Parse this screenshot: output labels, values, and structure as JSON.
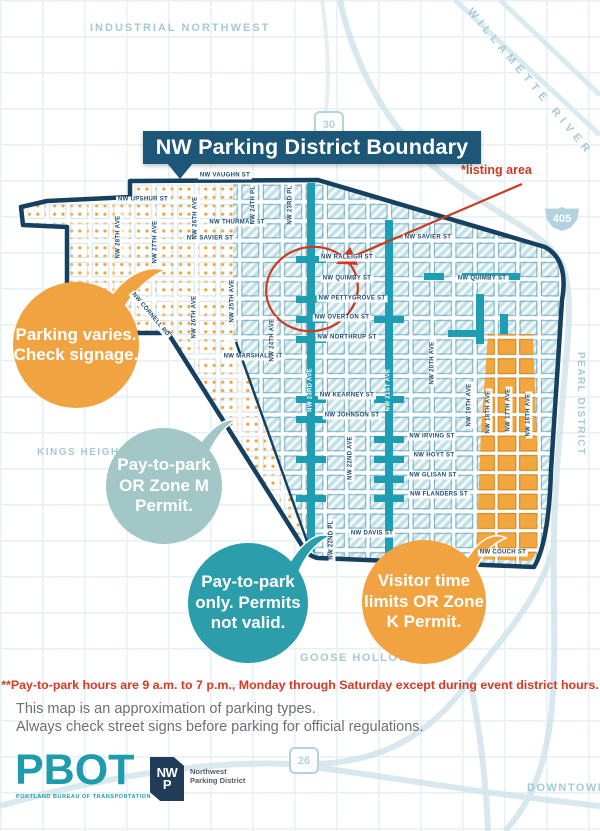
{
  "banner": {
    "title": "NW Parking District Boundary"
  },
  "annotation": {
    "listing_area": "*listing area",
    "color": "#cc3a22"
  },
  "map": {
    "region_labels": [
      {
        "t": "INDUSTRIAL NORTHWEST",
        "x": 90,
        "y": 22,
        "s": 11,
        "ls": 2,
        "r": 0
      },
      {
        "t": "WILLAMETTE RIVER",
        "x": 474,
        "y": 6,
        "s": 11,
        "ls": 5,
        "r": 50
      },
      {
        "t": "KINGS HEIGHTS",
        "x": 37,
        "y": 447,
        "s": 10,
        "ls": 1.5,
        "r": 0
      },
      {
        "t": "PEARL DISTRICT",
        "x": 586,
        "y": 352,
        "s": 10,
        "ls": 1.5,
        "r": 90
      },
      {
        "t": "GOOSE HOLLOW",
        "x": 300,
        "y": 652,
        "s": 11,
        "ls": 1.5,
        "r": 0
      },
      {
        "t": "DOWNTOWN",
        "x": 527,
        "y": 782,
        "s": 11,
        "ls": 1.5,
        "r": 0
      }
    ],
    "highway_shields": [
      {
        "t": "30",
        "x": 314,
        "y": 111,
        "type": "state"
      },
      {
        "t": "405",
        "x": 545,
        "y": 207,
        "type": "interstate"
      },
      {
        "t": "26",
        "x": 289,
        "y": 747,
        "type": "state"
      }
    ],
    "street_labels": [
      {
        "t": "NW VAUGHN ST",
        "x": 225,
        "y": 176,
        "r": 0
      },
      {
        "t": "NW UPSHUR ST",
        "x": 143,
        "y": 200,
        "r": 0
      },
      {
        "t": "NW THURMAN ST",
        "x": 237,
        "y": 223,
        "r": 0
      },
      {
        "t": "NW SAVIER ST",
        "x": 210,
        "y": 239,
        "r": 0
      },
      {
        "t": "NW SAVIER ST",
        "x": 428,
        "y": 238,
        "r": 0
      },
      {
        "t": "NW RALEIGH ST",
        "x": 347,
        "y": 258,
        "r": 0
      },
      {
        "t": "NW QUIMBY ST",
        "x": 347,
        "y": 279,
        "r": 0
      },
      {
        "t": "NW QUIMBY ST",
        "x": 482,
        "y": 279,
        "r": 0
      },
      {
        "t": "NW PETTYGROVE ST",
        "x": 352,
        "y": 299,
        "r": 0
      },
      {
        "t": "NW OVERTON ST",
        "x": 342,
        "y": 318,
        "r": 0
      },
      {
        "t": "NW NORTHRUP ST",
        "x": 347,
        "y": 338,
        "r": 0
      },
      {
        "t": "NW MARSHALL ST",
        "x": 253,
        "y": 357,
        "r": 0
      },
      {
        "t": "NW KEARNEY ST",
        "x": 347,
        "y": 396,
        "r": 0
      },
      {
        "t": "NW JOHNSON ST",
        "x": 352,
        "y": 416,
        "r": 0
      },
      {
        "t": "NW IRVING ST",
        "x": 432,
        "y": 437,
        "r": 0
      },
      {
        "t": "NW HOYT ST",
        "x": 434,
        "y": 456,
        "r": 0
      },
      {
        "t": "NW GLISAN ST",
        "x": 433,
        "y": 476,
        "r": 0
      },
      {
        "t": "NW FLANDERS ST",
        "x": 439,
        "y": 495,
        "r": 0
      },
      {
        "t": "NW DAVIS ST",
        "x": 372,
        "y": 534,
        "r": 0
      },
      {
        "t": "NW COUCH ST",
        "x": 503,
        "y": 553,
        "r": 0
      },
      {
        "t": "W BURNSIDE ST",
        "x": 262,
        "y": 569,
        "r": 4
      },
      {
        "t": "NW 28TH AVE",
        "x": 119,
        "y": 237,
        "r": -90
      },
      {
        "t": "NW 27TH AVE",
        "x": 156,
        "y": 242,
        "r": -90
      },
      {
        "t": "NW 26TH AVE",
        "x": 196,
        "y": 218,
        "r": -90
      },
      {
        "t": "NW 26TH AVE",
        "x": 195,
        "y": 317,
        "r": -90
      },
      {
        "t": "NW 25TH AVE",
        "x": 233,
        "y": 301,
        "r": -90
      },
      {
        "t": "NW 24TH PL",
        "x": 254,
        "y": 205,
        "r": -90
      },
      {
        "t": "NW 23RD PL",
        "x": 291,
        "y": 205,
        "r": -90
      },
      {
        "t": "NW 24TH AVE",
        "x": 273,
        "y": 340,
        "r": -90
      },
      {
        "t": "NW 23RD AVE",
        "x": 311,
        "y": 390,
        "r": -90,
        "cls": "onteal"
      },
      {
        "t": "NW 22ND AVE",
        "x": 351,
        "y": 458,
        "r": -90
      },
      {
        "t": "NW 22ND PL",
        "x": 332,
        "y": 540,
        "r": -90
      },
      {
        "t": "NW 21ST AVE",
        "x": 389,
        "y": 390,
        "r": -90,
        "cls": "onteal"
      },
      {
        "t": "NW 20TH AVE",
        "x": 433,
        "y": 363,
        "r": -90
      },
      {
        "t": "NW 19TH AVE",
        "x": 470,
        "y": 405,
        "r": -90
      },
      {
        "t": "NW 18TH AVE",
        "x": 489,
        "y": 412,
        "r": -90
      },
      {
        "t": "NW 17TH AVE",
        "x": 509,
        "y": 410,
        "r": -90
      },
      {
        "t": "NW 16TH AVE",
        "x": 529,
        "y": 415,
        "r": -90
      },
      {
        "t": "NW CORNELL RD",
        "x": 150,
        "y": 315,
        "r": 50
      }
    ],
    "zone_colors": {
      "boundary_navy": "#16405f",
      "hatch_fill": "#cfe7eb",
      "bold_street_teal": "#1f9db3",
      "dot_orange": "#eda33c",
      "orange_zone": "#f2a63e"
    }
  },
  "callouts": [
    {
      "name": "parking-varies",
      "color": "#f0a340",
      "cx": 76,
      "cy": 345,
      "r": 63,
      "lines": [
        "Parking varies.",
        "Check signage."
      ]
    },
    {
      "name": "zone-m",
      "color": "#a2c7c6",
      "cx": 164,
      "cy": 486,
      "r": 58,
      "lines": [
        "Pay-to-park",
        "OR Zone M",
        "Permit."
      ]
    },
    {
      "name": "pay-only",
      "color": "#2b9dab",
      "cx": 248,
      "cy": 603,
      "r": 60,
      "lines": [
        "Pay-to-park",
        "only. Permits",
        "not valid."
      ]
    },
    {
      "name": "zone-k",
      "color": "#f0a340",
      "cx": 424,
      "cy": 602,
      "r": 62,
      "lines": [
        "Visitor time",
        "limits OR Zone",
        "K Permit."
      ]
    }
  ],
  "notes": {
    "pay_hours": "**Pay-to-park hours are 9 a.m. to 7 p.m., Monday through Saturday except during event district hours.",
    "disclaimer_line1": "This map is an approximation of parking types.",
    "disclaimer_line2": "Always check street signs before parking for official regulations."
  },
  "footer": {
    "pbot_logo": "PBOT",
    "pbot_tagline": "PORTLAND BUREAU OF TRANSPORTATION",
    "nwp_letters_top": "NW",
    "nwp_letters_bottom": "P",
    "nwp_name_line1": "Northwest",
    "nwp_name_line2": "Parking District"
  }
}
